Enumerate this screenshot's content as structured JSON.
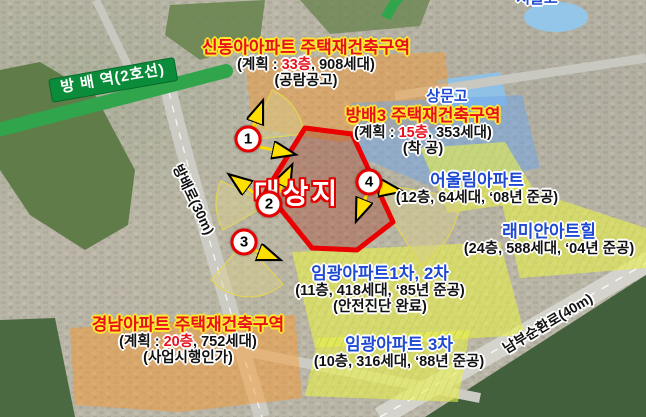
{
  "map": {
    "station": {
      "label": "방 배 역(2호선)"
    },
    "schools": {
      "sangmun": "상문고",
      "seoul": "서울고"
    },
    "roads": {
      "bangbae": "방배로(30m)",
      "nambu": "남부순환로(40m)"
    },
    "site": {
      "label": "대상지"
    },
    "markers": {
      "m1": "1",
      "m2": "2",
      "m3": "3",
      "m4": "4"
    },
    "zones": {
      "sindonga": {
        "title": "신동아아파트 주택재건축구역",
        "plan_prefix": "(계획 : ",
        "plan_floors": "33층",
        "plan_suffix": ", 908세대)",
        "status": "(공람공고)"
      },
      "bangbae3": {
        "title": "방배3 주택재건축구역",
        "plan_prefix": "(계획 : ",
        "plan_floors": "15층",
        "plan_suffix": ", 353세대)",
        "status": "(착 공)"
      },
      "gyeongnam": {
        "title": "경남아파트 주택재건축구역",
        "plan_prefix": "(계획 : ",
        "plan_floors": "20층",
        "plan_suffix": ", 752세대)",
        "status": "(사업시행인가)"
      }
    },
    "apartments": {
      "eoullim": {
        "name": "어울림아파트",
        "details": "(12층, 64세대, ‘08년 준공)"
      },
      "raemian": {
        "name": "래미안아트힐",
        "details": "(24층, 588세대, ‘04년 준공)"
      },
      "imgwang12": {
        "name": "임광아파트1차, 2차",
        "details": "(11층, 418세대, ‘85년 준공)",
        "extra": "(안전진단 완료)"
      },
      "imgwang3": {
        "name": "임광아파트 3차",
        "details": "(10층, 316세대, ‘88년 준공)"
      }
    },
    "colors": {
      "zone_title_red": "#e8101c",
      "zone_outline_yellow": "#ffe92e",
      "apartment_blue": "#1e49d2",
      "subway_green": "#31a54c",
      "site_border_red": "#e60000",
      "arrow_yellow": "#ffdf00"
    }
  }
}
